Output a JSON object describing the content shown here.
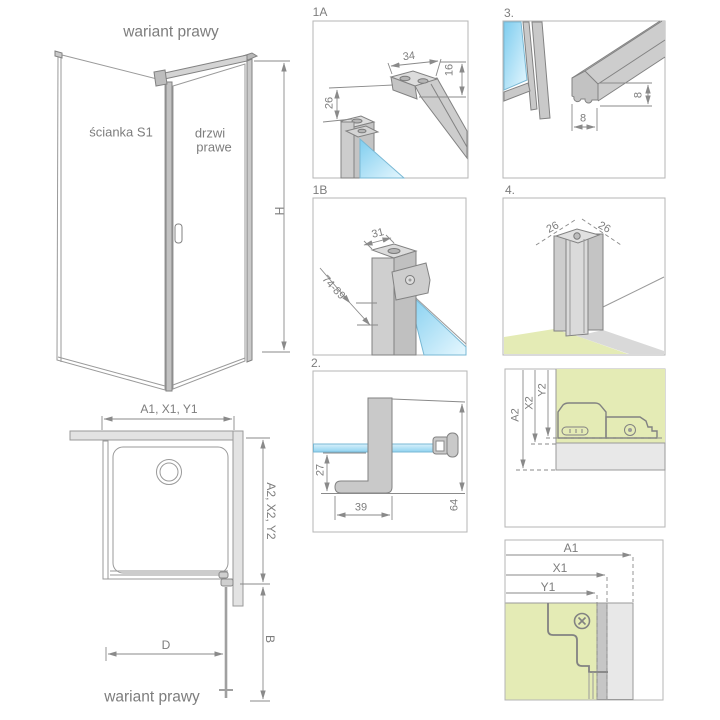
{
  "colors": {
    "glass_blue": "#9ad8f2",
    "floor_green": "#e4ebb5",
    "profile_gray": "#c9c9c9",
    "wall_gray": "#e3e3e3",
    "line_gray": "#8a8a8a",
    "text_gray": "#7d7d7d"
  },
  "iso_view": {
    "title": "wariant prawy",
    "wall_label": "ścianka S1",
    "door_label_line1": "drzwi",
    "door_label_line2": "prawe",
    "dim_height": "H"
  },
  "plan_view": {
    "dim_top": "A1, X1, Y1",
    "dim_right": "A2, X2, Y2",
    "dim_door_width": "D",
    "dim_bottom_right": "B",
    "caption": "wariant prawy"
  },
  "detail_1a": {
    "label": "1A",
    "dim_top": "34",
    "dim_side": "16",
    "dim_left": "26"
  },
  "detail_1b": {
    "label": "1B",
    "dim_top": "31",
    "dim_range": "74-89"
  },
  "detail_2": {
    "label": "2.",
    "dim_left": "27",
    "dim_bottom": "39",
    "dim_right": "64"
  },
  "detail_3": {
    "label": "3.",
    "dim_height": "8",
    "dim_width": "8"
  },
  "detail_4": {
    "label": "4.",
    "dim_left": "26",
    "dim_right": "26"
  },
  "detail_5": {
    "dim_a": "A2",
    "dim_x": "X2",
    "dim_y": "Y2"
  },
  "detail_6": {
    "dim_a": "A1",
    "dim_x": "X1",
    "dim_y": "Y1"
  }
}
